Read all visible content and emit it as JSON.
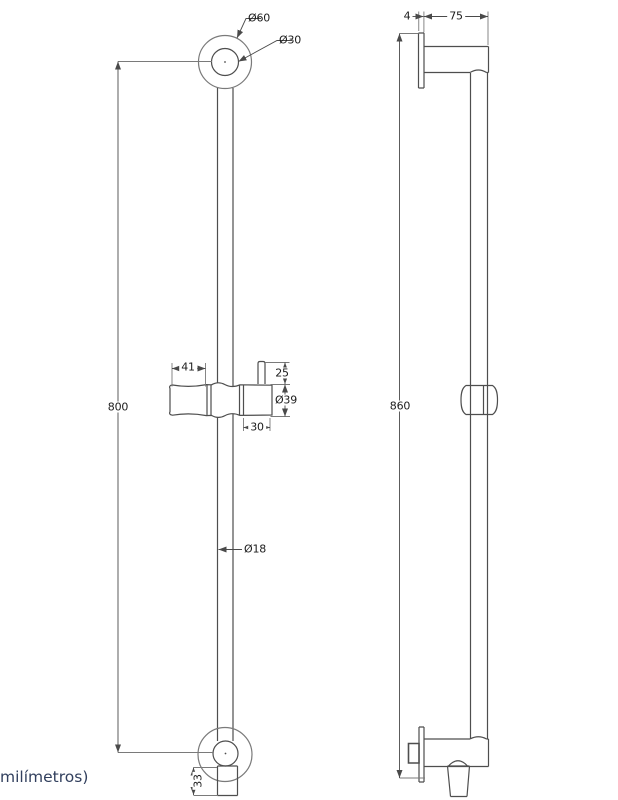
{
  "note": "milímetros)",
  "front_view": {
    "dim_dia_outer_top": "Ø60",
    "dim_dia_inner_top": "Ø30",
    "dim_overall_height": "800",
    "dim_slider_handle_length": "41",
    "dim_hook_height": "25",
    "dim_slider_diameter": "Ø39",
    "dim_holder_width": "30",
    "dim_bar_diameter": "Ø18",
    "dim_outlet_height": "33"
  },
  "side_view": {
    "dim_plate_thickness": "4",
    "dim_wall_offset": "75",
    "dim_overall_height": "860"
  },
  "colors": {
    "object_line": "#4e4e4e",
    "light_line": "#7a7a7a",
    "dimension_line": "#4a4a4a",
    "label_text": "#1c1c1c",
    "note_text": "#32405e"
  }
}
